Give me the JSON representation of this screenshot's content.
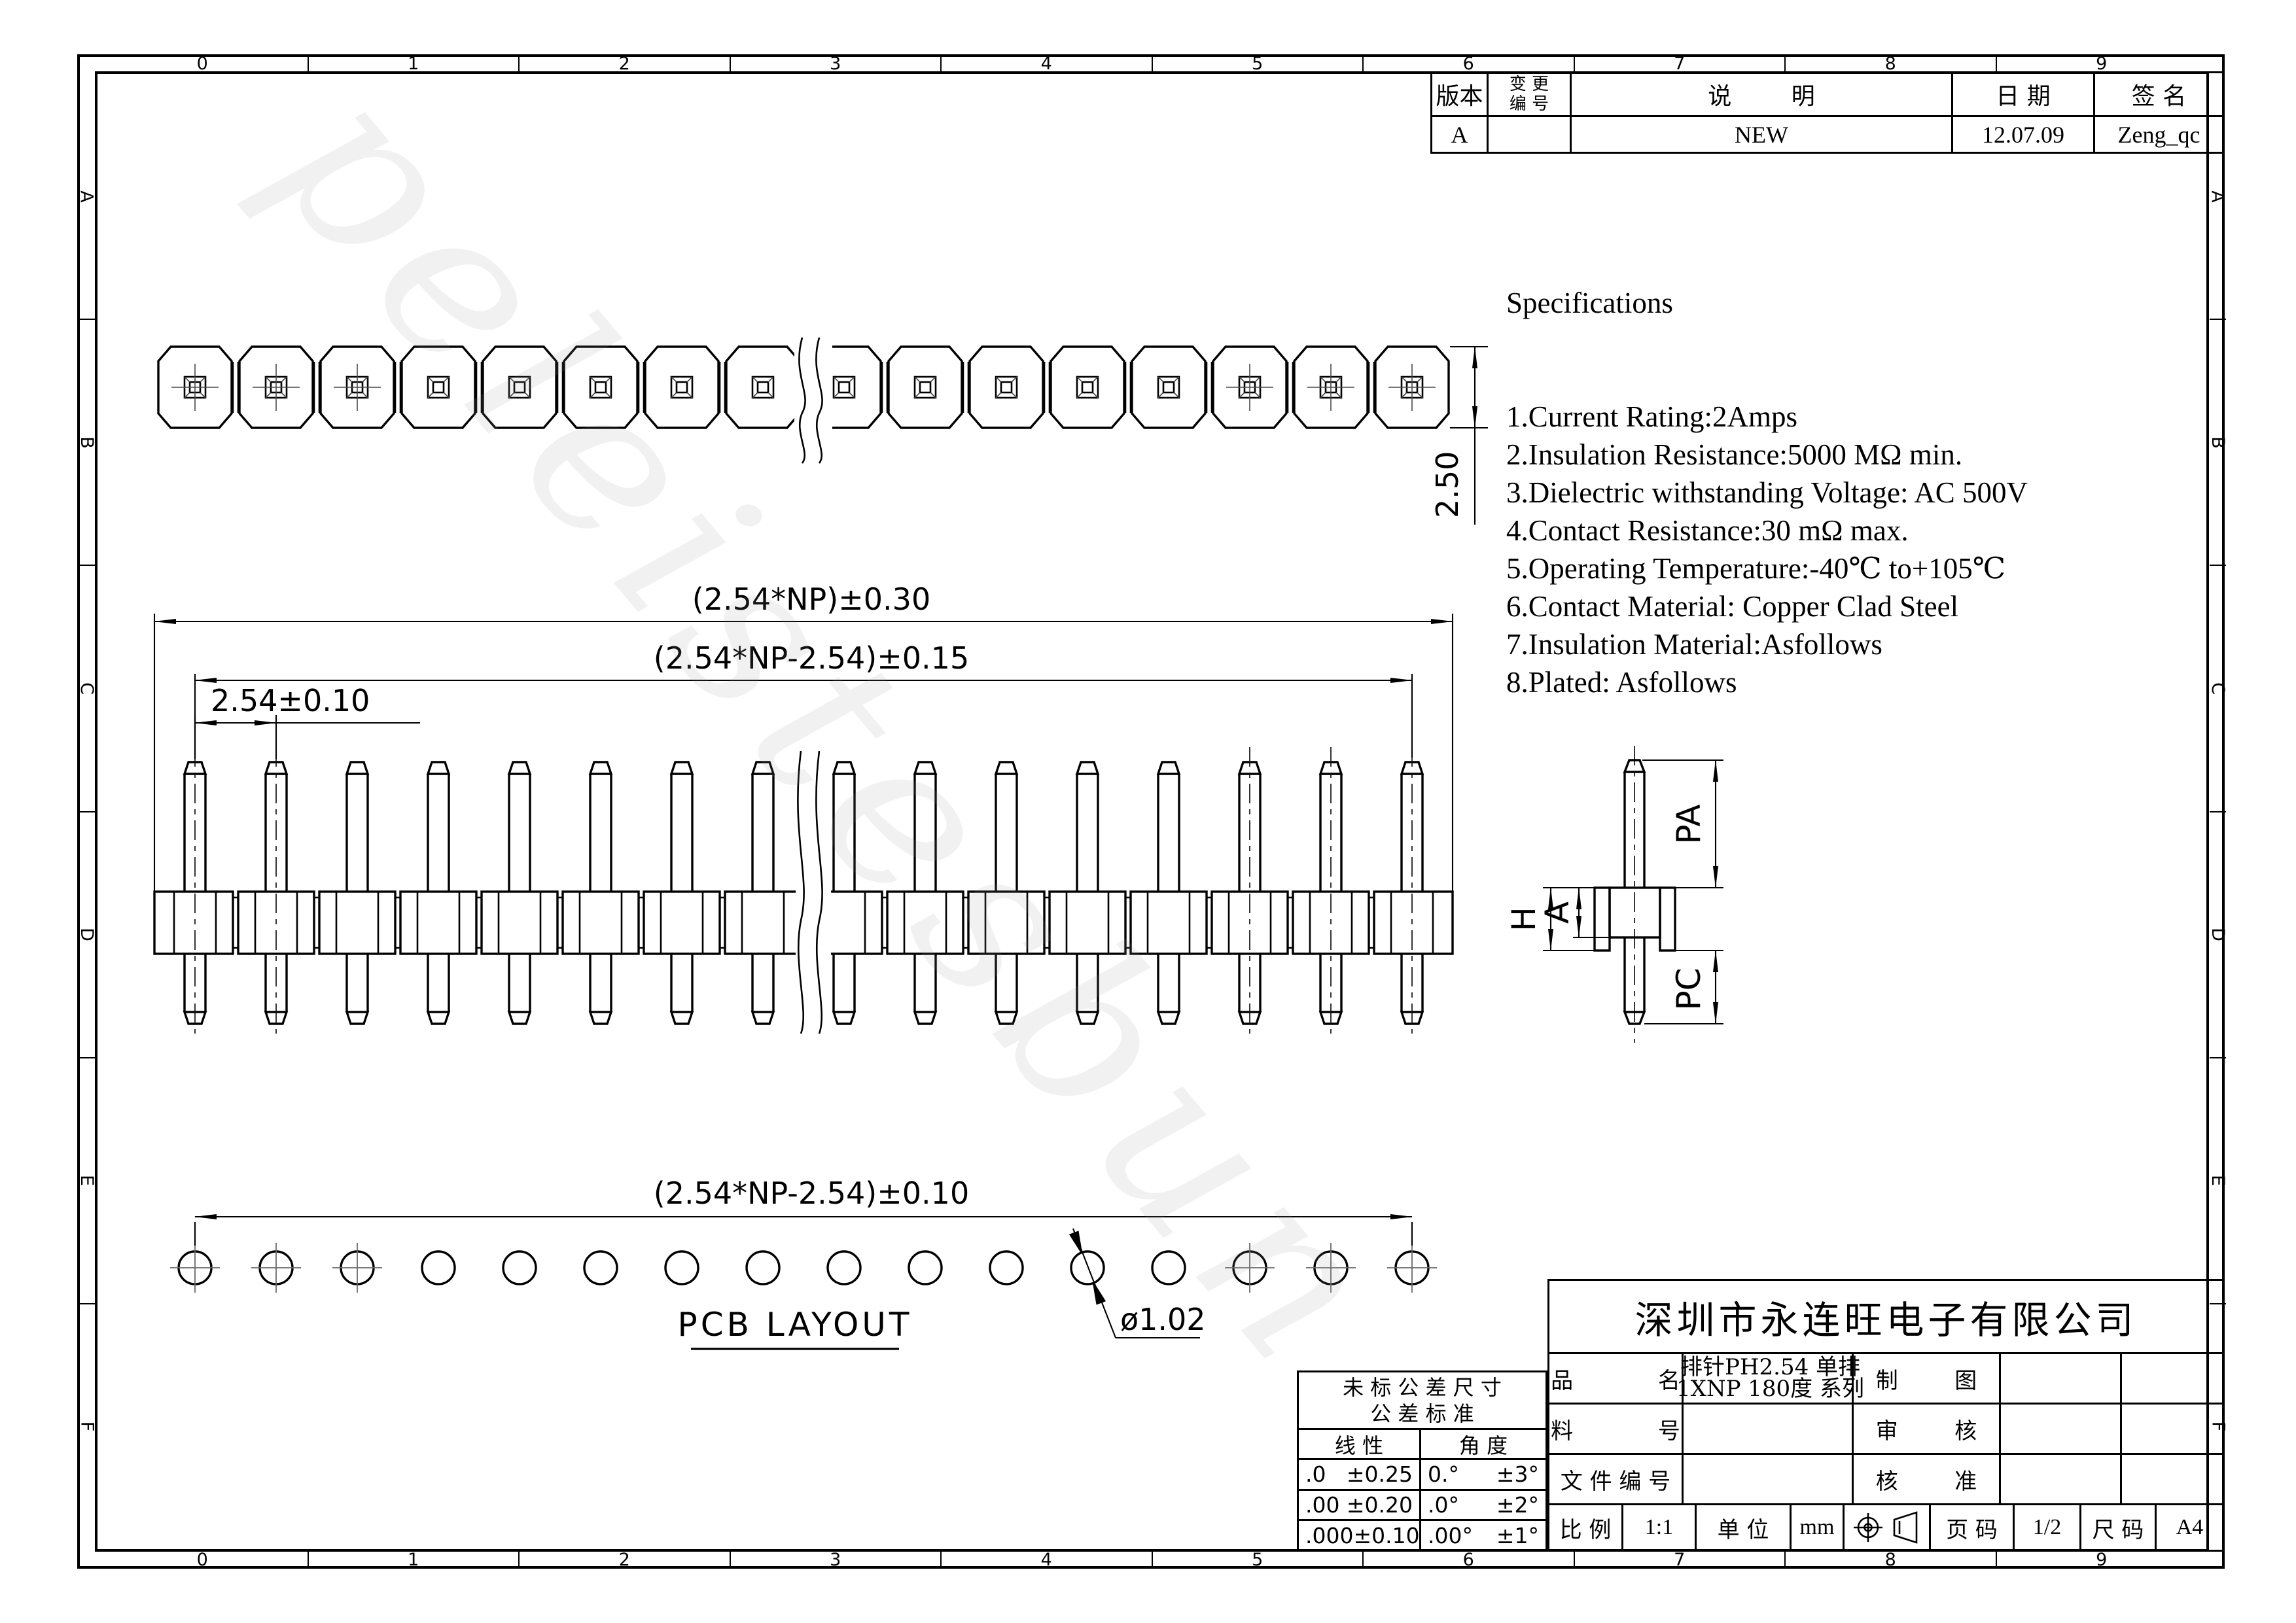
{
  "zones": {
    "numbers": [
      "0",
      "1",
      "2",
      "3",
      "4",
      "5",
      "6",
      "7",
      "8",
      "9"
    ],
    "letters": [
      "A",
      "B",
      "C",
      "D",
      "E",
      "F"
    ]
  },
  "revision_table": {
    "col_version": "版本",
    "col_change_line1": "变 更",
    "col_change_line2": "编 号",
    "col_description": "说        明",
    "col_date": "日 期",
    "col_sign": "签 名",
    "row": {
      "version": "A",
      "change_no": "",
      "description": "NEW",
      "date": "12.07.09",
      "signature": "Zeng_qc"
    }
  },
  "specs": {
    "title": "Specifications",
    "items": [
      "1.Current Rating:2Amps",
      "2.Insulation Resistance:5000 MΩ min.",
      "3.Dielectric withstanding Voltage: AC 500V",
      "4.Contact Resistance:30 mΩ max.",
      "5.Operating Temperature:-40℃ to+105℃",
      "6.Contact Material: Copper Clad Steel",
      "7.Insulation Material:Asfollows",
      "8.Plated: Asfollows"
    ]
  },
  "dims": {
    "overall": "(2.54*NP)±0.30",
    "centers": "(2.54*NP-2.54)±0.15",
    "pitch": "2.54±0.10",
    "height": "2.50",
    "pcb_span": "(2.54*NP-2.54)±0.10",
    "hole_dia": "ø1.02",
    "pcb_label": "PCB LAYOUT",
    "pa": "PA",
    "h": "H",
    "a": "A",
    "pc": "PC"
  },
  "tolerance_table": {
    "title_line1": "未 标 公 差 尺 寸",
    "title_line2": "公 差 标 准",
    "col_linear": "线 性",
    "col_angle": "角 度",
    "rows": [
      {
        "lin_d": ".0",
        "lin_t": "±0.25",
        "ang_d": "0.°",
        "ang_t": "±3°"
      },
      {
        "lin_d": ".00",
        "lin_t": "±0.20",
        "ang_d": ".0°",
        "ang_t": "±2°"
      },
      {
        "lin_d": ".000",
        "lin_t": "±0.10",
        "ang_d": ".00°",
        "ang_t": "±1°"
      }
    ]
  },
  "title_block": {
    "company": "深圳市永连旺电子有限公司",
    "product_label": "品            名",
    "product_value_line1": "排针PH2.54 单排",
    "product_value_line2": "1XNP 180度 系列",
    "draw_label": "制        图",
    "draw_value": "",
    "material_label": "料            号",
    "material_value": "",
    "check_label": "审        核",
    "check_value": "",
    "docno_label": "文 件 编 号",
    "docno_value": "",
    "approve_label": "核        准",
    "approve_value": "",
    "scale_label": "比 例",
    "scale_value": "1:1",
    "unit_label": "单 位",
    "unit_value": "mm",
    "page_label": "页 码",
    "page_value": "1/2",
    "size_label": "尺 码",
    "size_value": "A4"
  },
  "watermark": "peleistesbun"
}
